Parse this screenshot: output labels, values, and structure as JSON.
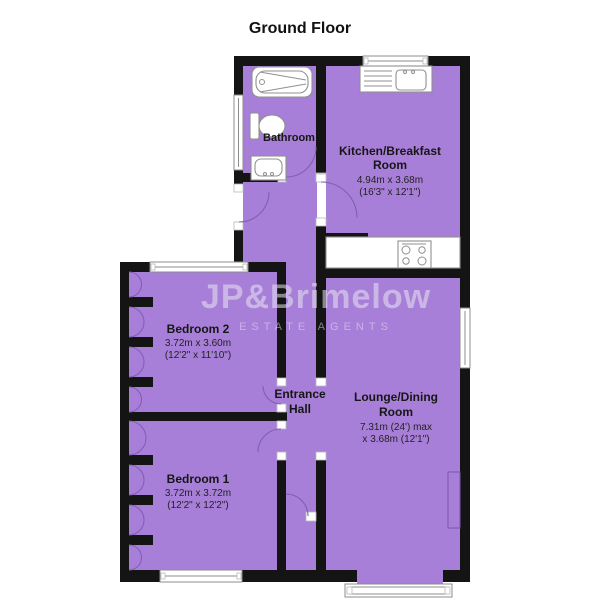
{
  "title": "Ground Floor",
  "watermark": {
    "name": "JP&Brimelow",
    "tagline": "ESTATE AGENTS"
  },
  "rooms": {
    "bathroom": {
      "name": "Bathroom"
    },
    "kitchen": {
      "name_line1": "Kitchen/Breakfast",
      "name_line2": "Room",
      "dims_metric": "4.94m x 3.68m",
      "dims_imperial": "(16'3\" x 12'1\")"
    },
    "bedroom2": {
      "name": "Bedroom 2",
      "dims_metric": "3.72m x 3.60m",
      "dims_imperial": "(12'2\" x 11'10\")"
    },
    "entrance_hall": {
      "name_line1": "Entrance",
      "name_line2": "Hall"
    },
    "lounge": {
      "name_line1": "Lounge/Dining",
      "name_line2": "Room",
      "dims_line1": "7.31m (24') max",
      "dims_line2": "x 3.68m (12'1\")"
    },
    "bedroom1": {
      "name": "Bedroom 1",
      "dims_metric": "3.72m x 3.72m",
      "dims_imperial": "(12'2\" x 12'2\")"
    }
  },
  "colors": {
    "floor": "#a87fd8",
    "wall": "#141414",
    "door_arc": "#7e60b0",
    "window_frame": "#8c8c8c",
    "watermark": "#e9e5f0"
  },
  "fixtures": [
    "bathtub",
    "toilet",
    "washbasin",
    "kitchen-sink",
    "drainer",
    "hob",
    "chimney-breast"
  ]
}
